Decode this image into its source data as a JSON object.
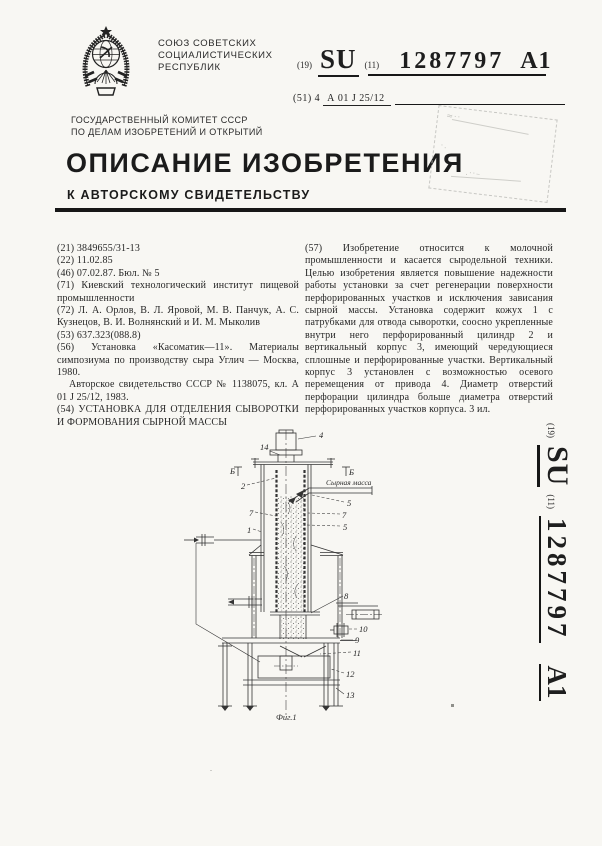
{
  "header": {
    "country_lines": [
      "СОЮЗ СОВЕТСКИХ",
      "СОЦИАЛИСТИЧЕСКИХ",
      "РЕСПУБЛИК"
    ],
    "code19": "(19)",
    "su": "SU",
    "code11": "(11)",
    "doc_number": "1287797",
    "kind_code": "A1",
    "code51": "(51) 4",
    "ipc_class": "А 01 J 25/12",
    "committee_line1": "ГОСУДАРСТВЕННЫЙ КОМИТЕТ СССР",
    "committee_line2": "ПО ДЕЛАМ ИЗОБРЕТЕНИЙ И ОТКРЫТИЙ",
    "doc_title": "ОПИСАНИЕ ИЗОБРЕТЕНИЯ",
    "doc_subtitle": "К АВТОРСКОМУ СВИДЕТЕЛЬСТВУ"
  },
  "biblio": {
    "f21": "(21) 3849655/31-13",
    "f22": "(22) 11.02.85",
    "f46": "(46) 07.02.87. Бюл. № 5",
    "f71": "(71) Киевский технологический институт пищевой промышленности",
    "f72": "(72) Л. А. Орлов, В. Л. Яровой, М. В. Панчук, А. С. Кузнецов, В. И. Волнянский и И. М. Мыколив",
    "f53": "(53) 637.323(088.8)",
    "f56a": "(56) Установка «Касоматик—11». Материалы симпозиума по производству сыра Углич — Москва, 1980.",
    "f56b": "Авторское свидетельство СССР № 1138075, кл. А 01 J 25/12, 1983.",
    "f54": "(54) УСТАНОВКА ДЛЯ ОТДЕЛЕНИЯ СЫВОРОТКИ И ФОРМОВАНИЯ СЫРНОЙ МАССЫ"
  },
  "abstract": {
    "f57": "(57) Изобретение относится к молочной промышленности и касается сыродельной техники. Целью изобретения является повышение надежности работы установки за счет регенерации поверхности перфорированных участков и исключения зависания сырной массы. Установка содержит кожух 1 с патрубками для отвода сыворотки, соосно укрепленные внутри него перфорированный цилиндр 2 и вертикальный корпус 3, имеющий чередующиеся сплошные и перфорированные участки. Вертикальный корпус 3 установлен с возможностью осевого перемещения от привода 4. Диаметр отверстий перфорации цилиндра больше диаметра отверстий перфорированных участков корпуса. 3 ил."
  },
  "figure": {
    "caption": "Фиг.1",
    "flow_annotation": "Сырная масса",
    "section_mark": "Б",
    "labels": {
      "n1": "1",
      "n2": "2",
      "n4": "4",
      "n5a": "5",
      "n5b": "5",
      "n7a": "7",
      "n7b": "7",
      "n8": "8",
      "n9": "9",
      "n10": "10",
      "n11": "11",
      "n12": "12",
      "n13": "13",
      "n14": "14"
    }
  },
  "sidebar": {
    "code19": "(19)",
    "su": "SU",
    "code11": "(11)",
    "doc_number": "1287797",
    "kind_code": "A1"
  }
}
